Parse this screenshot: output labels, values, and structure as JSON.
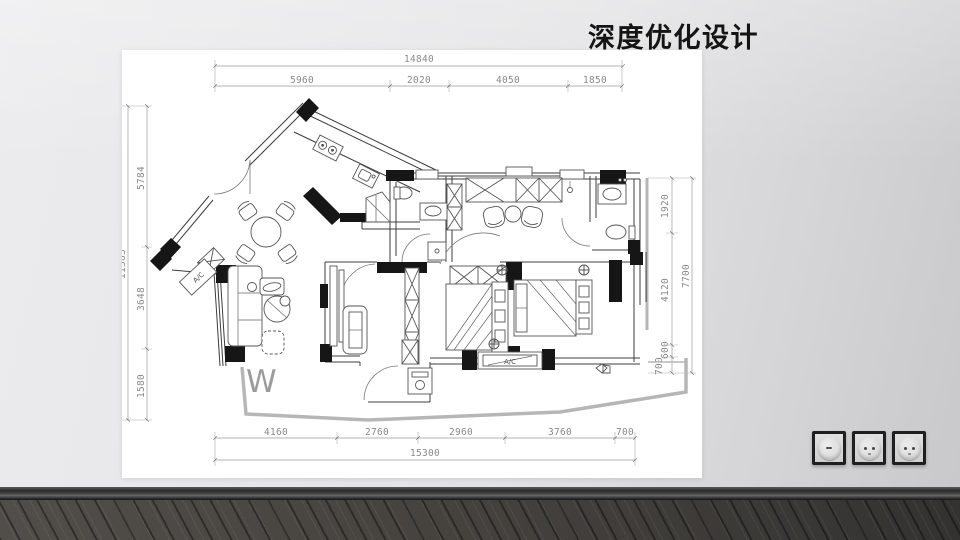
{
  "slide": {
    "title": "深度优化设计"
  },
  "plan": {
    "dims_top": {
      "total": "14840",
      "segments": [
        "5960",
        "2020",
        "4050",
        "1850"
      ]
    },
    "dims_bottom": {
      "total": "15300",
      "segments": [
        "4160",
        "2760",
        "2960",
        "3760",
        "700"
      ]
    },
    "dims_left": {
      "total": "11383",
      "segments": [
        "5784",
        "3648",
        "1580"
      ]
    },
    "dims_right": {
      "total": "7700",
      "segments": [
        "1920",
        "4120",
        "600",
        "700"
      ]
    },
    "labels": {
      "ac_wing": "A/C",
      "ac_bottom": "A/C",
      "watermark": "W"
    }
  },
  "wall": {
    "sockets": [
      "blank-button-plate",
      "power-outlet",
      "power-outlet"
    ],
    "accent_colors": {
      "wall": "#e2e2e4",
      "floor_wood": "#46433f",
      "plate_frame": "#1f1f1f"
    }
  }
}
